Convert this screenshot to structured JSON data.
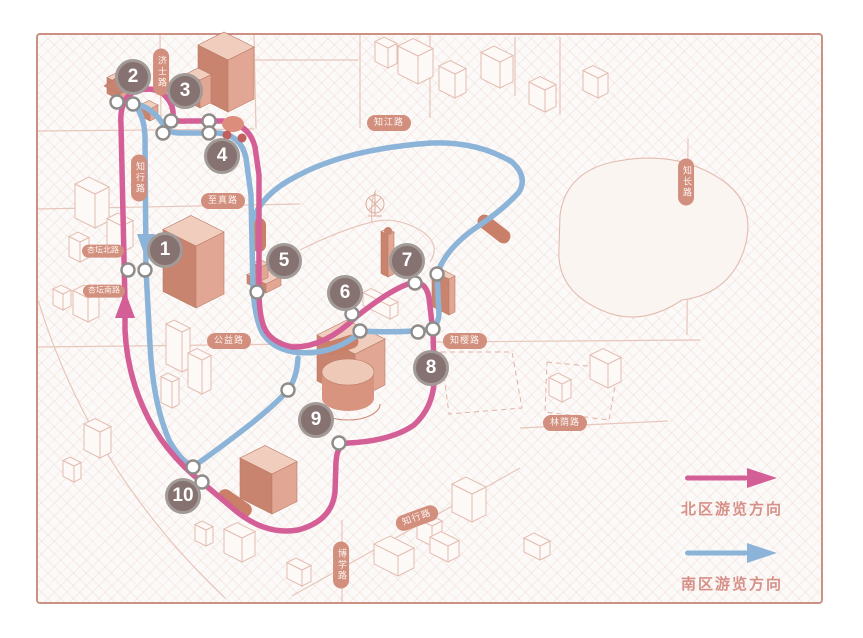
{
  "legend": {
    "north_label": "北区游览方向",
    "south_label": "南区游览方向"
  },
  "routes": {
    "north_color": "#d45f96",
    "south_color": "#8cb4d9"
  },
  "stops": [
    {
      "number": "1",
      "x": 165,
      "y": 250
    },
    {
      "number": "2",
      "x": 133,
      "y": 77
    },
    {
      "number": "3",
      "x": 185,
      "y": 91
    },
    {
      "number": "4",
      "x": 222,
      "y": 156
    },
    {
      "number": "5",
      "x": 284,
      "y": 261
    },
    {
      "number": "6",
      "x": 345,
      "y": 293
    },
    {
      "number": "7",
      "x": 407,
      "y": 261
    },
    {
      "number": "8",
      "x": 431,
      "y": 368
    },
    {
      "number": "9",
      "x": 316,
      "y": 420
    },
    {
      "number": "10",
      "x": 183,
      "y": 496
    }
  ],
  "road_labels": [
    {
      "text": "济士路",
      "x": 161,
      "y": 72,
      "orientation": "vertical"
    },
    {
      "text": "知行路",
      "x": 139,
      "y": 178,
      "orientation": "vertical"
    },
    {
      "text": "知江路",
      "x": 389,
      "y": 123,
      "orientation": "horizontal"
    },
    {
      "text": "至真路",
      "x": 223,
      "y": 201,
      "orientation": "horizontal"
    },
    {
      "text": "杏坛北路",
      "x": 103,
      "y": 251,
      "orientation": "horizontal"
    },
    {
      "text": "杏坛南路",
      "x": 104,
      "y": 291,
      "orientation": "horizontal"
    },
    {
      "text": "公益路",
      "x": 229,
      "y": 341,
      "orientation": "horizontal"
    },
    {
      "text": "知樱路",
      "x": 465,
      "y": 341,
      "orientation": "horizontal"
    },
    {
      "text": "林荫路",
      "x": 565,
      "y": 423,
      "orientation": "horizontal"
    },
    {
      "text": "知行路",
      "x": 417,
      "y": 518,
      "orientation": "horizontal",
      "rotate": -20
    },
    {
      "text": "博学路",
      "x": 341,
      "y": 565,
      "orientation": "vertical"
    },
    {
      "text": "知长路",
      "x": 686,
      "y": 182,
      "orientation": "vertical"
    }
  ]
}
